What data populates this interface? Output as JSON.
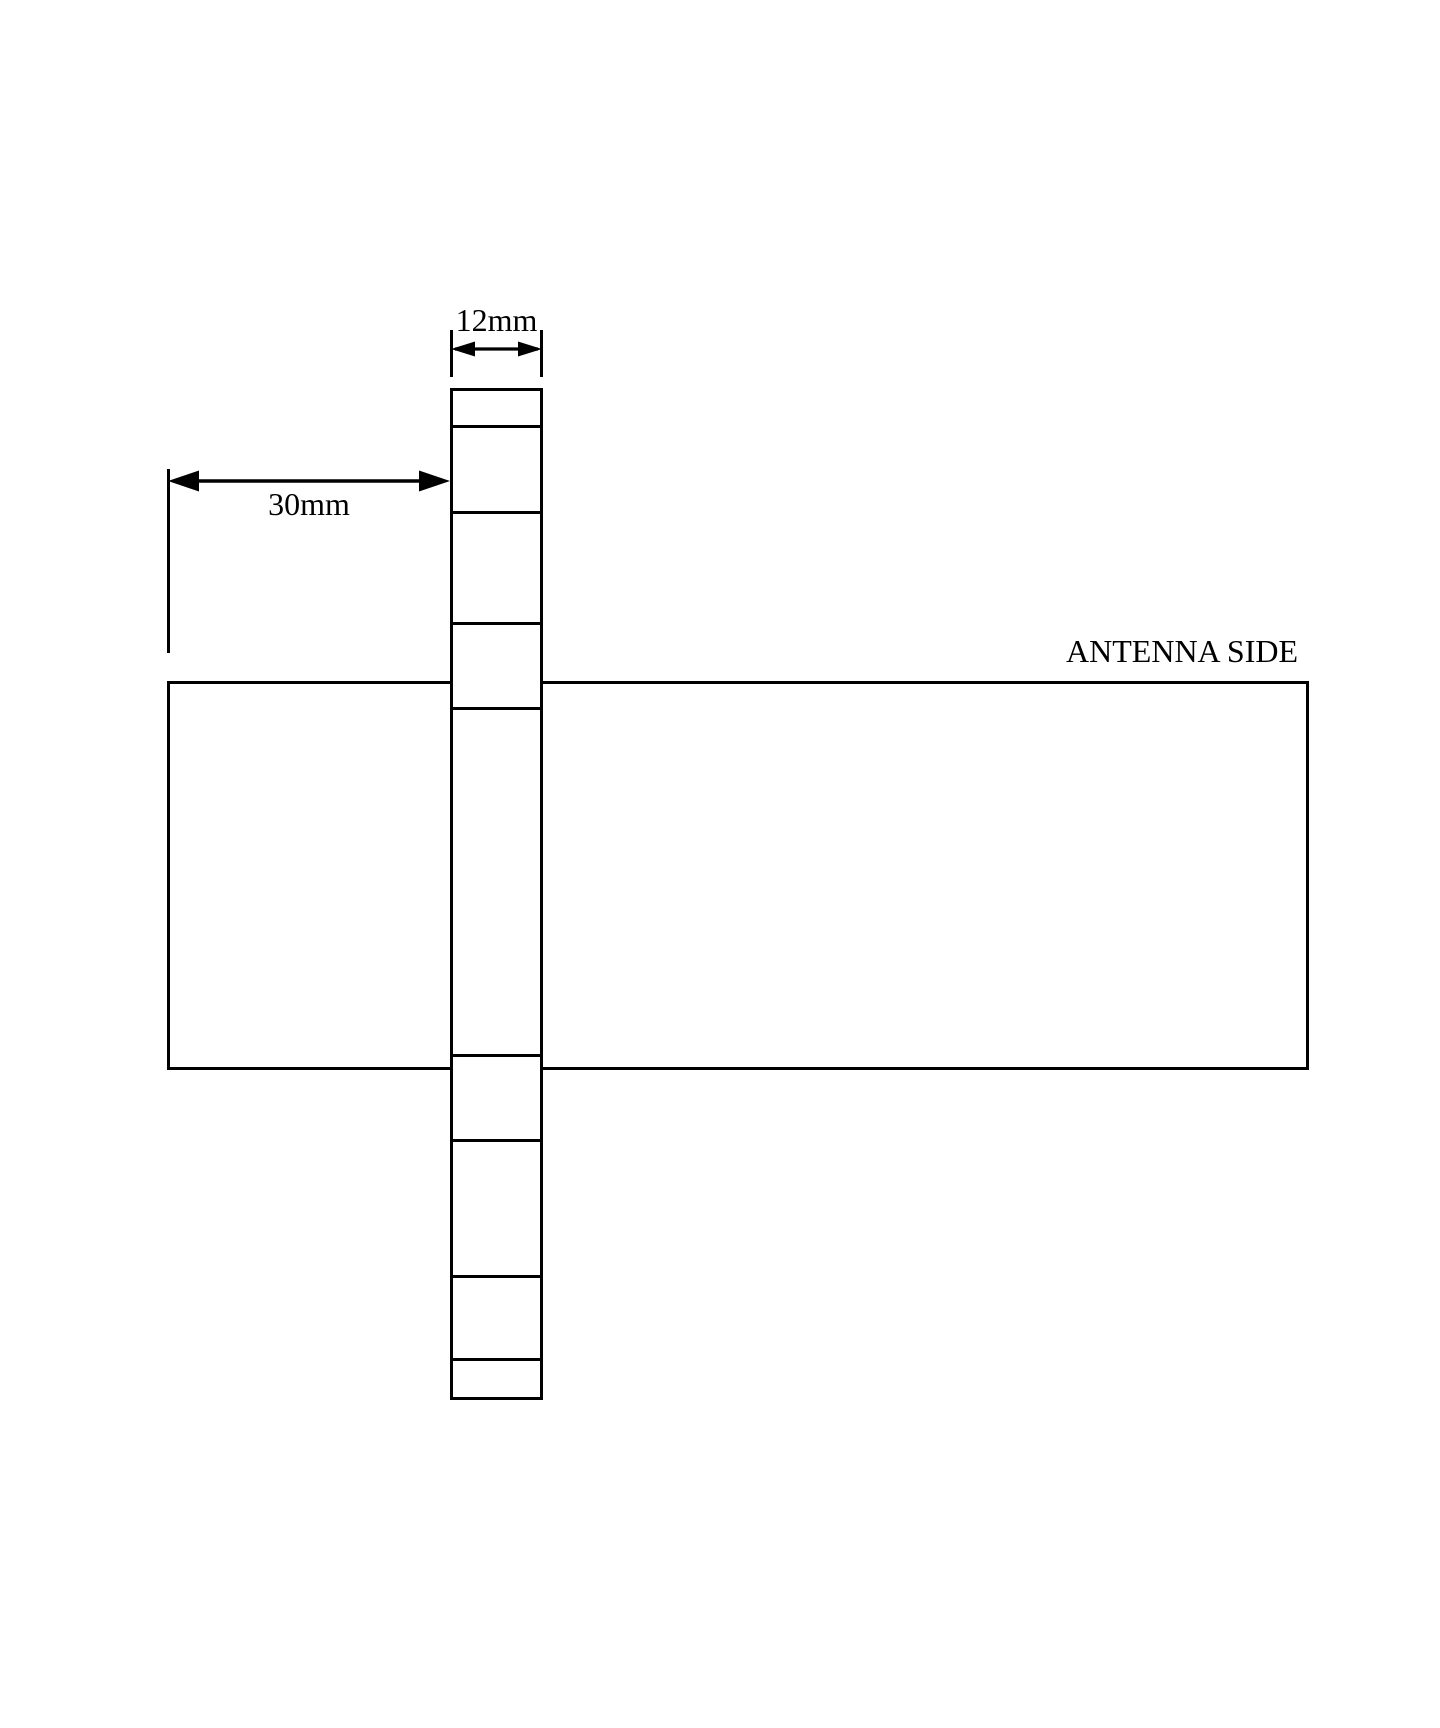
{
  "page": {
    "width_px": 1440,
    "height_px": 1728,
    "background_color": "#ffffff",
    "ink_color": "#000000"
  },
  "diagram": {
    "kind": "antenna-mechanical-drawing",
    "annotations": {
      "strip_width_label": "12mm",
      "strip_offset_label": "30mm",
      "board_label": "ANTENNA SIDE"
    },
    "strip": {
      "left_px": 450,
      "top_px": 388,
      "width_px": 93,
      "height_px": 1012,
      "segment_count": 9,
      "divider_offsets_px": [
        37,
        123,
        234,
        319,
        666,
        751,
        887,
        970
      ]
    },
    "board": {
      "left_px": 167,
      "top_px": 681,
      "width_px": 1142,
      "height_px": 389
    }
  }
}
